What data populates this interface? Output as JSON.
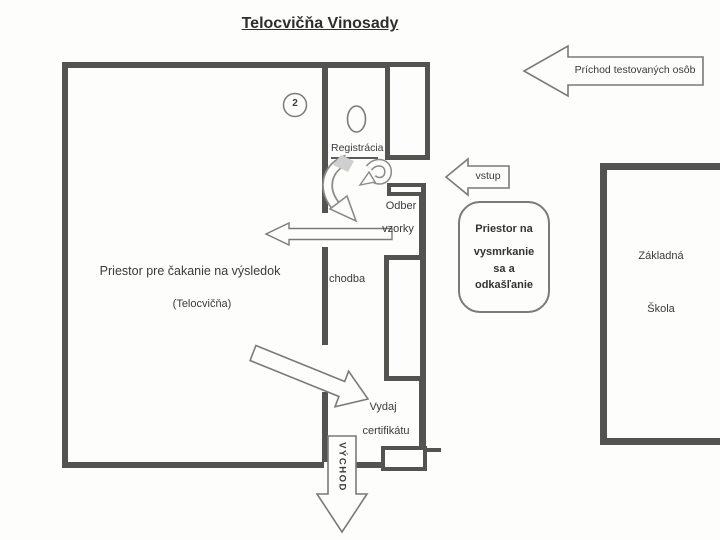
{
  "title": "Telocvičňa Vinosady",
  "annotations": {
    "station_number": "2",
    "registration": "Registrácia",
    "corridor": "chodba",
    "sample": {
      "line1": "Odber",
      "line2": "vzorky"
    },
    "waiting": {
      "line1": "Priestor pre čakanie na výsledok",
      "line2": "(Telocvičňa)"
    },
    "certificate": {
      "line1": "Vydaj",
      "line2": "certifikátu"
    },
    "blow_room": {
      "line1": "Priestor na",
      "line2": "vysmrkanie",
      "line3": "sa a",
      "line4": "odkašľanie"
    },
    "school": {
      "line1": "Základná",
      "line2": "Škola"
    }
  },
  "arrows": {
    "arrival": "Príchod testovaných osôb",
    "entry": "vstup",
    "exit": "VÝCHOD"
  },
  "colors": {
    "wall": "#535350",
    "arrow_outline": "#7a7a7a",
    "ink": "#383838",
    "paper": "#fdfdfb"
  }
}
